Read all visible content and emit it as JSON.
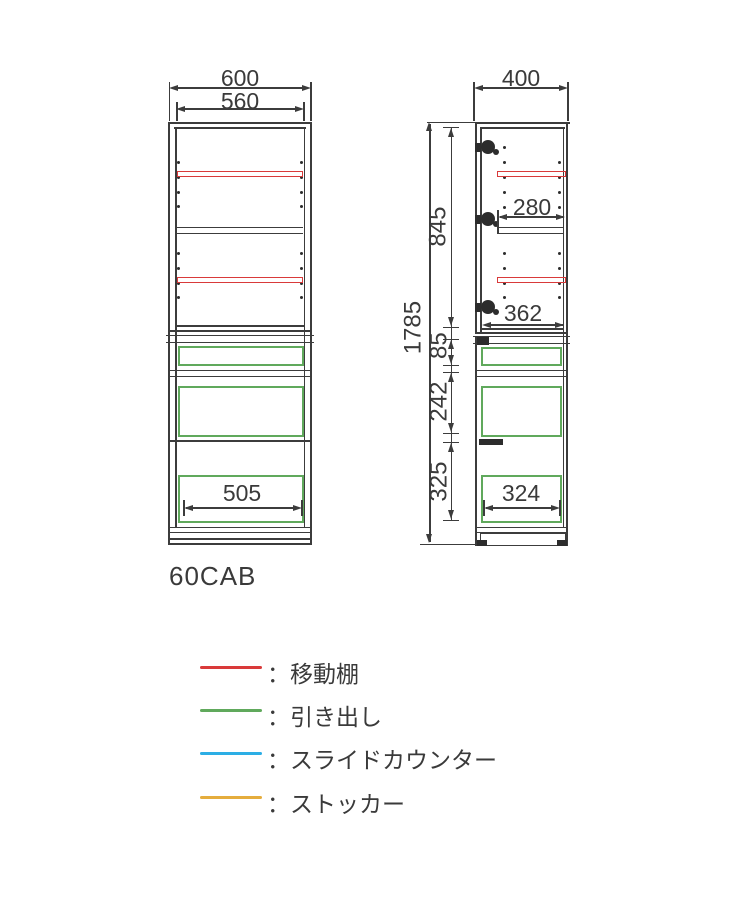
{
  "title": "60CAB",
  "front_view": {
    "width_outer": "600",
    "width_inner": "560",
    "drawer_width": "505"
  },
  "side_view": {
    "depth": "400",
    "total_height": "1785",
    "upper_height": "845",
    "shelf_depth": "280",
    "lower_shelf_depth": "362",
    "counter_section": "85",
    "middle_section": "242",
    "bottom_section": "325",
    "drawer_depth": "324"
  },
  "legend": {
    "separator": "：",
    "items": [
      {
        "label": "移動棚",
        "color": "#d93a3a"
      },
      {
        "label": "引き出し",
        "color": "#60a95c"
      },
      {
        "label": "スライドカウンター",
        "color": "#2caee5"
      },
      {
        "label": "ストッカー",
        "color": "#e5ad3d"
      }
    ]
  },
  "colors": {
    "line_art": "#3c3c3c",
    "movable_shelf": "#d93a3a",
    "drawer": "#60a95c",
    "slide_counter": "#2caee5",
    "stocker": "#e5ad3d"
  }
}
